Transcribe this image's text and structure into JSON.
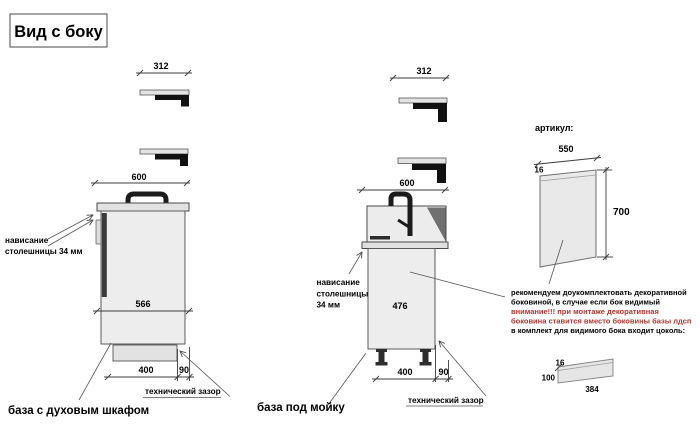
{
  "title": "Вид с боку",
  "colors": {
    "warning_red": "#b0342f"
  },
  "left_unit": {
    "label": "база с духовым шкафом",
    "dim_top_piece": "312",
    "dim_countertop": "600",
    "dim_front_height": "566",
    "dim_plinth_inset": "400",
    "dim_tech_gap": "90",
    "overhang_line1": "нависание",
    "overhang_line2": "столешницы 34 мм",
    "tech_gap_label": "технический зазор"
  },
  "middle_unit": {
    "label": "база под мойку",
    "dim_top_piece": "312",
    "dim_countertop": "600",
    "dim_front_height": "476",
    "dim_plinth_inset": "400",
    "dim_tech_gap": "90",
    "overhang_line1": "нависание",
    "overhang_line2": "столешницы",
    "overhang_line3": "34 мм",
    "tech_gap_label": "технический зазор"
  },
  "side_panel": {
    "heading": "артикул:",
    "dim_width": "550",
    "dim_thickness": "16",
    "dim_height": "700",
    "notes": {
      "line1": "рекомендуем доукомплектовать декоративной",
      "line2": "боковиной, в случае если бок видимый",
      "line3": "внимание!!! при монтаже декоративная",
      "line4": "боковина ставится вместо боковины базы лдсп",
      "line5": "в комплект для видимого бока входит цоколь:"
    },
    "plinth": {
      "dim_thickness": "16",
      "dim_height": "100",
      "dim_length": "384"
    }
  }
}
